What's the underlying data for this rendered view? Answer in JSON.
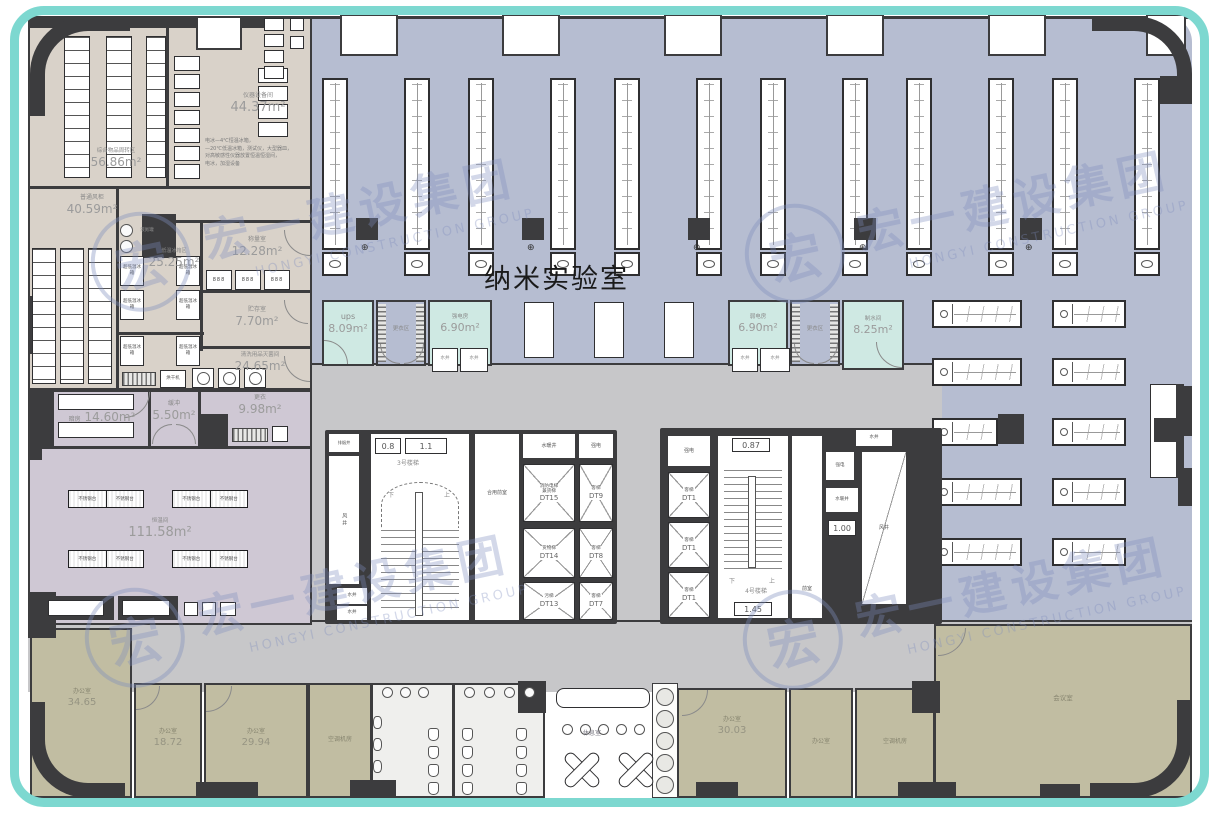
{
  "title": "纳米实验室",
  "watermark": {
    "cn": "宏一建设集团",
    "en": "HONGYI CONSTRUCTION GROUP",
    "logo": "宏"
  },
  "rooms": {
    "turnover_name": "综合物品周转区",
    "turnover_area": "56.86m²",
    "instr_name": "仪器设备间",
    "instr_area": "44.37m²",
    "instr_n1": "电冰—4℃恒温冰箱，",
    "instr_n2": "—20℃低温冰箱，测试仪，大型器皿，",
    "instr_n3": "对高敏感性仪器放置恒温恒湿间，",
    "instr_n4": "电冰，加湿设备",
    "ordinary_name": "普通风柜",
    "ordinary_area": "40.59m²",
    "freezer_name": "低温冰箱区",
    "freezer_area": "25.25m²",
    "freezer_unit": "超低温冰箱",
    "tank": "液氮罐",
    "weigh_name": "称量室",
    "weigh_area": "12.28m²",
    "scale": "888",
    "store_name": "贮存室",
    "store_area": "7.70m²",
    "wash_name": "清洗用品灭菌间",
    "wash_area": "24.65m²",
    "dryer": "烘干机",
    "dark_name": "暗房",
    "dark_area": "14.60m²",
    "buffer_name": "缓冲",
    "buffer_area": "5.50m²",
    "chg_name": "更衣",
    "chg_area": "9.98m²",
    "const_name": "恒温间",
    "const_area": "111.58m²",
    "bench": "不锈钢台"
  },
  "service": {
    "ups_name": "ups",
    "ups_area": "8.09m²",
    "strong": "强电房",
    "strong_area": "6.90m²",
    "weak": "弱电房",
    "weak_area": "6.90m²",
    "water": "制水间",
    "water_area": "8.25m²",
    "changing": "更衣区",
    "well": "水井"
  },
  "core_left": {
    "smoke": "排烟井",
    "air": "风井",
    "well": "水井",
    "stair": "3号楼梯",
    "n1": "0.8",
    "n2": "1.1",
    "lobby": "合用前室",
    "plumb": "水暖井",
    "power": "强电",
    "down": "下",
    "up": "上",
    "e15a": "消防电梯",
    "e15b": "兼货梯",
    "e15": "DT15",
    "e14a": "货物梯",
    "e14": "DT14",
    "e13a": "污梯",
    "e13": "DT13",
    "pass": "客梯",
    "e9": "DT9",
    "e8": "DT8",
    "e7": "DT7"
  },
  "core_right": {
    "power": "强电",
    "pass": "客梯",
    "e1": "DT1",
    "stair": "4号楼梯",
    "n1": "0.87",
    "n2": "1.45",
    "n3": "1.00",
    "lobby": "前室",
    "plumb": "水暖井",
    "air": "风井",
    "well": "水井",
    "down": "下",
    "up": "上"
  },
  "offices": {
    "o1n": "办公室",
    "o1a": "34.65",
    "o2n": "办公室",
    "o2a": "18.72",
    "o3n": "办公室",
    "o3a": "29.94",
    "o4n": "空调机房",
    "o5n": "休息室",
    "o6n": "办公室",
    "o6a": "30.03",
    "o7n": "办公室",
    "o8n": "空调机房",
    "o9n": "会议室"
  }
}
